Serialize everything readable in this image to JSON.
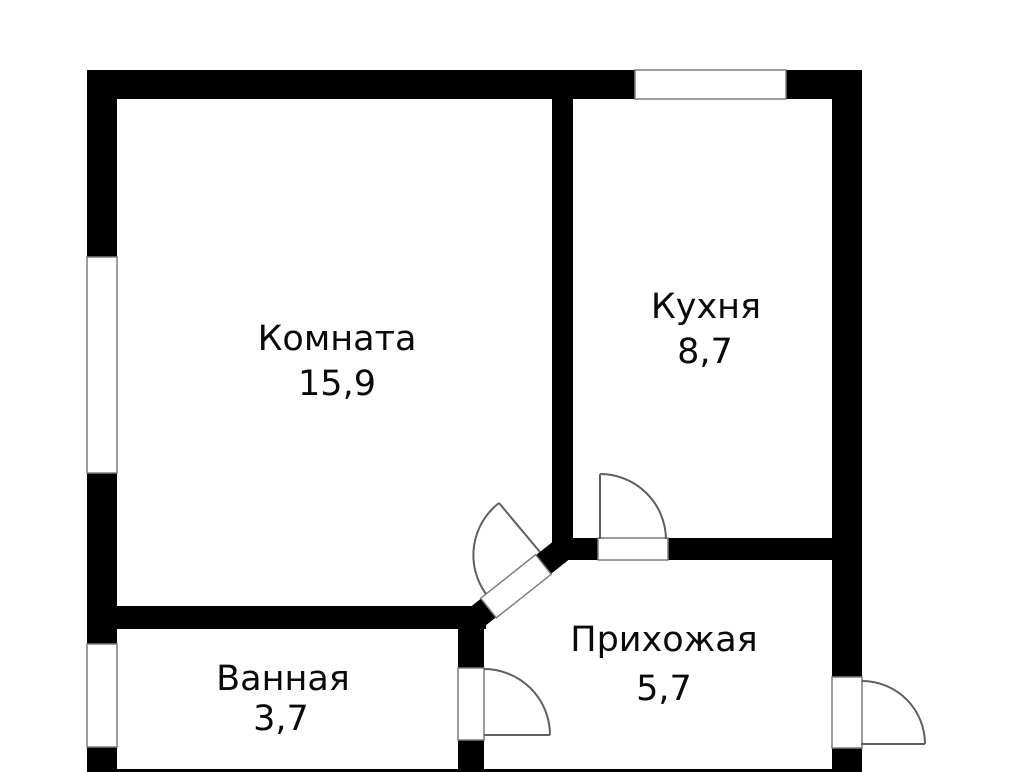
{
  "floorplan": {
    "type": "apartment-floor-plan",
    "colors": {
      "background": "#ffffff",
      "wall": "#000000",
      "opening_fill": "#ffffff",
      "opening_outline": "#7d7d7d",
      "door_swing": "#5f5f5f",
      "text": "#0a0a0a"
    },
    "rooms": [
      {
        "name": "Комната",
        "area": "15,9"
      },
      {
        "name": "Кухня",
        "area": "8,7"
      },
      {
        "name": "Ванная",
        "area": "3,7"
      },
      {
        "name": "Прихожая",
        "area": "5,7"
      }
    ]
  }
}
